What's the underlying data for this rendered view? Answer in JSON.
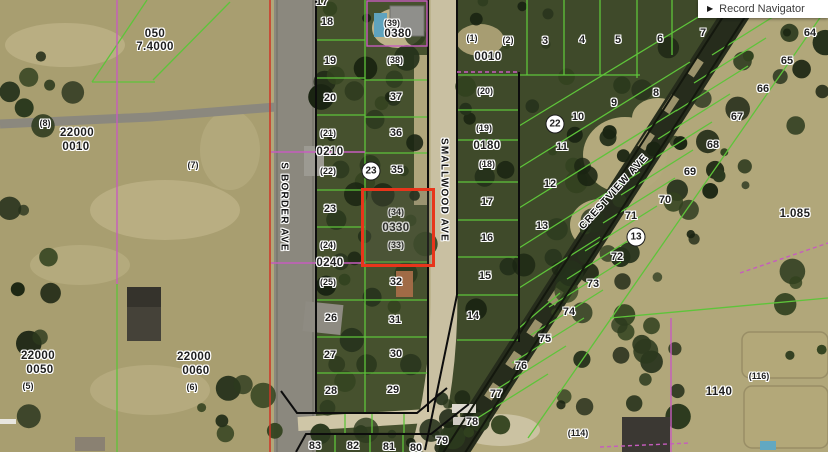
{
  "record_navigator": {
    "icon": "▶",
    "label": "Record Navigator"
  },
  "colors": {
    "parcel_line": "#5ec43a",
    "block_boundary": "#0d0d0d",
    "alt_boundary": "#c65cbe",
    "section_line": "#cf3526",
    "highlight": "#e8351b",
    "label_text": "#1f1f1f",
    "label_halo": "#ffffff"
  },
  "streets": [
    {
      "name": "S BORDER AVE",
      "x": 284,
      "y": 207,
      "angle": 90
    },
    {
      "name": "SMALLWOOD AVE",
      "x": 444,
      "y": 190,
      "angle": 90
    },
    {
      "name": "CRESTVIEW AVE",
      "x": 614,
      "y": 192,
      "angle": -48
    }
  ],
  "labels": {
    "lots": [
      {
        "t": "17",
        "x": 322,
        "y": 2
      },
      {
        "t": "18",
        "x": 327,
        "y": 22
      },
      {
        "t": "19",
        "x": 330,
        "y": 61
      },
      {
        "t": "20",
        "x": 330,
        "y": 98
      },
      {
        "t": "23",
        "x": 330,
        "y": 209
      },
      {
        "t": "26",
        "x": 331,
        "y": 318
      },
      {
        "t": "27",
        "x": 330,
        "y": 355
      },
      {
        "t": "28",
        "x": 331,
        "y": 391
      },
      {
        "t": "37",
        "x": 396,
        "y": 97
      },
      {
        "t": "36",
        "x": 396,
        "y": 133
      },
      {
        "t": "35",
        "x": 397,
        "y": 170
      },
      {
        "t": "32",
        "x": 396,
        "y": 282
      },
      {
        "t": "31",
        "x": 395,
        "y": 320
      },
      {
        "t": "30",
        "x": 396,
        "y": 354
      },
      {
        "t": "29",
        "x": 393,
        "y": 390
      },
      {
        "t": "83",
        "x": 315,
        "y": 446
      },
      {
        "t": "82",
        "x": 353,
        "y": 446
      },
      {
        "t": "81",
        "x": 389,
        "y": 447
      },
      {
        "t": "80",
        "x": 416,
        "y": 448
      },
      {
        "t": "79",
        "x": 442,
        "y": 441
      },
      {
        "t": "78",
        "x": 472,
        "y": 422
      },
      {
        "t": "77",
        "x": 496,
        "y": 394
      },
      {
        "t": "76",
        "x": 521,
        "y": 366
      },
      {
        "t": "75",
        "x": 545,
        "y": 339
      },
      {
        "t": "74",
        "x": 569,
        "y": 312
      },
      {
        "t": "73",
        "x": 593,
        "y": 284
      },
      {
        "t": "72",
        "x": 617,
        "y": 257
      },
      {
        "t": "71",
        "x": 631,
        "y": 216
      },
      {
        "t": "70",
        "x": 665,
        "y": 200
      },
      {
        "t": "69",
        "x": 690,
        "y": 172
      },
      {
        "t": "68",
        "x": 713,
        "y": 145
      },
      {
        "t": "67",
        "x": 737,
        "y": 117
      },
      {
        "t": "66",
        "x": 763,
        "y": 89
      },
      {
        "t": "65",
        "x": 787,
        "y": 61
      },
      {
        "t": "64",
        "x": 810,
        "y": 33
      },
      {
        "t": "3",
        "x": 545,
        "y": 41
      },
      {
        "t": "4",
        "x": 582,
        "y": 40
      },
      {
        "t": "5",
        "x": 618,
        "y": 40
      },
      {
        "t": "6",
        "x": 660,
        "y": 39
      },
      {
        "t": "7",
        "x": 703,
        "y": 33
      },
      {
        "t": "8",
        "x": 656,
        "y": 93
      },
      {
        "t": "9",
        "x": 614,
        "y": 103
      },
      {
        "t": "10",
        "x": 578,
        "y": 117
      },
      {
        "t": "11",
        "x": 562,
        "y": 147
      },
      {
        "t": "12",
        "x": 550,
        "y": 184
      },
      {
        "t": "13",
        "x": 542,
        "y": 226
      },
      {
        "t": "14",
        "x": 473,
        "y": 316
      },
      {
        "t": "15",
        "x": 485,
        "y": 276
      },
      {
        "t": "16",
        "x": 487,
        "y": 238
      },
      {
        "t": "17",
        "x": 487,
        "y": 202
      }
    ],
    "parens": [
      {
        "t": "(39)",
        "x": 392,
        "y": 23
      },
      {
        "t": "(38)",
        "x": 395,
        "y": 60
      },
      {
        "t": "(21)",
        "x": 328,
        "y": 133
      },
      {
        "t": "(22)",
        "x": 328,
        "y": 171
      },
      {
        "t": "(24)",
        "x": 328,
        "y": 245
      },
      {
        "t": "(25)",
        "x": 328,
        "y": 282
      },
      {
        "t": "(34)",
        "x": 396,
        "y": 212
      },
      {
        "t": "(33)",
        "x": 396,
        "y": 245
      },
      {
        "t": "(1)",
        "x": 472,
        "y": 38
      },
      {
        "t": "(2)",
        "x": 508,
        "y": 40
      },
      {
        "t": "(20)",
        "x": 485,
        "y": 91
      },
      {
        "t": "(19)",
        "x": 484,
        "y": 128
      },
      {
        "t": "(18)",
        "x": 487,
        "y": 164
      },
      {
        "t": "(8)",
        "x": 45,
        "y": 123
      },
      {
        "t": "(7)",
        "x": 193,
        "y": 165
      },
      {
        "t": "(5)",
        "x": 28,
        "y": 386
      },
      {
        "t": "(6)",
        "x": 192,
        "y": 387
      },
      {
        "t": "(114)",
        "x": 578,
        "y": 433
      },
      {
        "t": "(116)",
        "x": 759,
        "y": 376
      }
    ],
    "parcels": [
      {
        "t": "0380",
        "x": 398,
        "y": 34
      },
      {
        "t": "0210",
        "x": 330,
        "y": 152
      },
      {
        "t": "0240",
        "x": 330,
        "y": 263
      },
      {
        "t": "0330",
        "x": 396,
        "y": 228
      },
      {
        "t": "0010",
        "x": 488,
        "y": 57
      },
      {
        "t": "0180",
        "x": 487,
        "y": 146
      },
      {
        "t": "050",
        "x": 155,
        "y": 34
      },
      {
        "t": "7.4000",
        "x": 155,
        "y": 47
      },
      {
        "t": "22000",
        "x": 77,
        "y": 133
      },
      {
        "t": "0010",
        "x": 76,
        "y": 147
      },
      {
        "t": "22000",
        "x": 38,
        "y": 356
      },
      {
        "t": "0050",
        "x": 40,
        "y": 370
      },
      {
        "t": "22000",
        "x": 194,
        "y": 357
      },
      {
        "t": "0060",
        "x": 196,
        "y": 371
      },
      {
        "t": "1140",
        "x": 719,
        "y": 392
      },
      {
        "t": "1.085",
        "x": 795,
        "y": 214
      }
    ],
    "circled": [
      {
        "t": "23",
        "x": 371,
        "y": 171
      },
      {
        "t": "22",
        "x": 555,
        "y": 124
      },
      {
        "t": "13",
        "x": 636,
        "y": 237
      }
    ]
  }
}
